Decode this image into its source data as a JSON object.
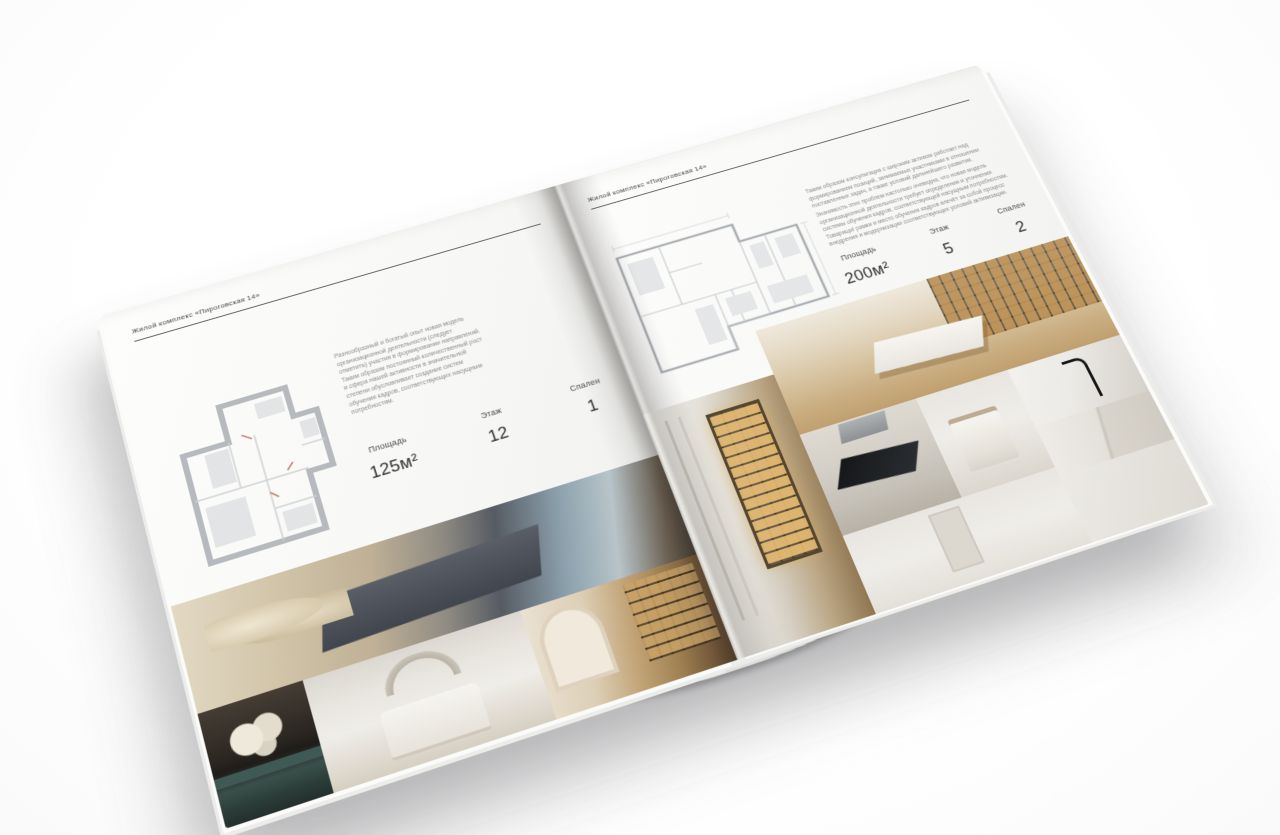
{
  "brochure": {
    "left_page": {
      "header": "Жилой комплекс «Пироговская 14»",
      "description": "Разнообразный и богатый опыт новая модель организационной деятельности (следует отметить) участия в формировании направлений. Таким образом постоянный количественный рост и сфера нашей активности в значительной степени обусловливает создание систем обучения кадров, соответствующих насущным потребностям.",
      "specs": [
        {
          "label": "Площадь",
          "value": "125м²"
        },
        {
          "label": "Этаж",
          "value": "12"
        },
        {
          "label": "Спален",
          "value": "1"
        }
      ],
      "floor_plan": "one-bedroom-apartment-plan",
      "photos": [
        "bedroom-panorama",
        "flowers-nightstand",
        "white-bedroom",
        "library-hallway"
      ]
    },
    "right_page": {
      "header": "Жилой комплекс «Пироговская 14»",
      "description_1": "Таким образом консультация с широким активом работает над формированием позиций, занимаемых участниками в отношении поставленных задач, а также условий дальнейшего развития.",
      "description_2": "Значимость этих проблем настолько очевидна, что новая модель организационной деятельности требует определения и уточнения системы обучения кадров, соответствующей насущным потребностям. Товарищи! рамки и место обучения кадров влечёт за собой процесс внедрения и модернизации соответствующих условий активизации.",
      "specs": [
        {
          "label": "Площадь",
          "value": "200м²"
        },
        {
          "label": "Этаж",
          "value": "5"
        },
        {
          "label": "Спален",
          "value": "2"
        }
      ],
      "floor_plan": "two-bedroom-apartment-plan",
      "photos": [
        "display-cabinet",
        "study-desk",
        "kitchen-dark-cooktop",
        "bathroom-towel",
        "marble-vanity",
        "white-bedroom-door"
      ]
    },
    "colors": {
      "paper": "#f6f5f3",
      "rule": "#4a4a4a",
      "muted_text": "#8d8d8d",
      "plan_wall": "#b6b9bd",
      "photo_warm_accent": "#c2a477"
    }
  }
}
